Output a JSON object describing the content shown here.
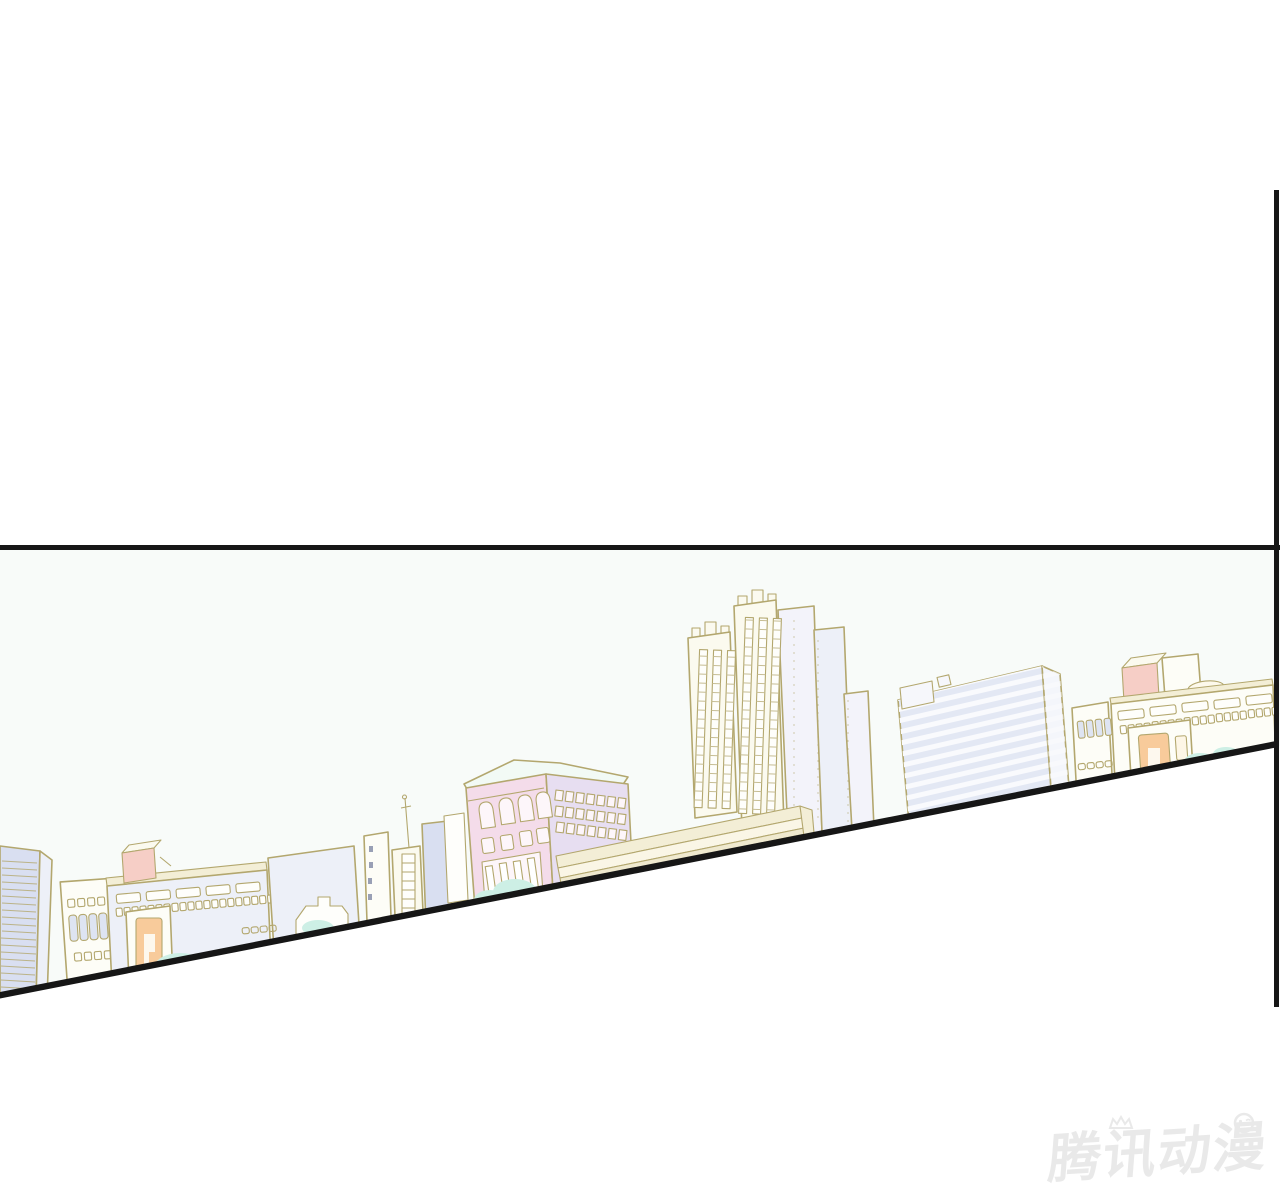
{
  "page": {
    "kind": "comic-reader-page",
    "background": "#ffffff",
    "width": 1280,
    "height": 1200
  },
  "panel": {
    "description": "Slanted comic panel showing a pastel city skyline under a pale sky",
    "top_border": {
      "y": 545,
      "thickness": 5,
      "x_start": 0,
      "x_end": 1280
    },
    "right_border": {
      "x": 1274,
      "y_start": 190,
      "y_end": 1007,
      "thickness": 5
    },
    "bottom_border": {
      "from_x": 0,
      "from_y": 995,
      "to_x": 1276,
      "to_y": 744,
      "thickness": 6
    },
    "scene": {
      "buildings": [
        "striped lavender tower (far left, clipped)",
        "small cream block with window rows",
        "wide low-rise with salmon roof box and peach doorway",
        "blank pale block and tiny stepped rooftops",
        "narrow white towers with antenna mast",
        "pink classical hall with arched windows and columned entry",
        "long cream colonnade roof sloping with the panel edge",
        "three cream high-rises with finial roofs and window strips",
        "large tilted office slab with horizontal floor bands",
        "small cream block with tall windows",
        "right cluster: salmon roof box, white tower, window-strip hall, peach doorway",
        "mint bushes along the slanted ground line"
      ]
    }
  },
  "palette": {
    "ink": "#161616",
    "sky": "#f8fbf9",
    "outline": "#b3a76e",
    "outline_soft": "#c6bd93",
    "lavender": "#d9dff1",
    "lavender_light": "#edf0f8",
    "lavender_mid": "#e3e8f4",
    "cream": "#fbfaef",
    "white_warm": "#fdfdf7",
    "pink_face": "#f4dcea",
    "purple_side": "#e7def1",
    "salmon": "#f6cec6",
    "peach": "#f8cb9b",
    "mint": "#cdefe5",
    "band_cream": "#f3eed6",
    "window_white": "#fefefb",
    "window_blue": "#dee4f2",
    "watermark": "#e9e9e9"
  },
  "watermark": {
    "text": "腾讯动漫",
    "meaning": "Tencent Comics watermark",
    "color": "#e9e9e9"
  }
}
